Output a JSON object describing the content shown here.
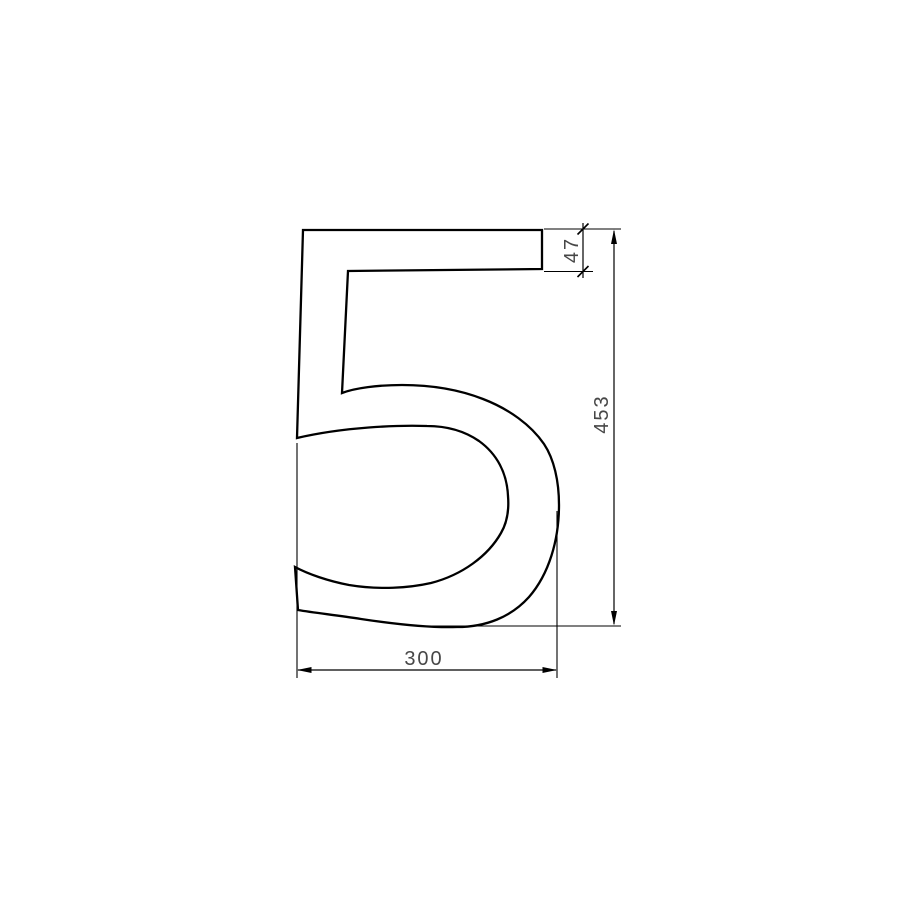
{
  "drawing": {
    "kind": "dimensioned-technical-drawing",
    "subject": "outline of numeral five",
    "glyph": "5",
    "dimensions": {
      "width": {
        "value": "300",
        "orientation": "horizontal",
        "position": "bottom"
      },
      "height": {
        "value": "453",
        "orientation": "vertical",
        "position": "right"
      },
      "bar_thickness": {
        "value": "47",
        "orientation": "vertical",
        "position": "top-right"
      }
    },
    "colors": {
      "line": "#000000",
      "dimension_text": "#474747",
      "background": "#ffffff"
    }
  }
}
